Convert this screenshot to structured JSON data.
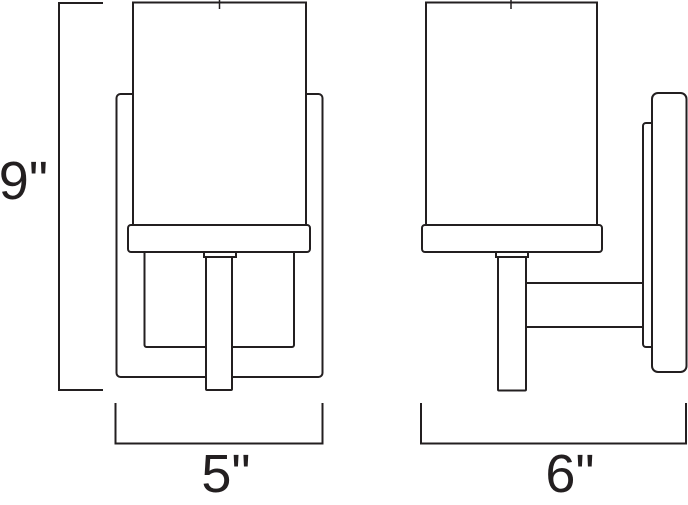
{
  "diagram": {
    "dimensions": {
      "height": {
        "label": "9\""
      },
      "width": {
        "label": "5\""
      },
      "depth": {
        "label": "6\""
      }
    },
    "colors": {
      "line": "#231f20",
      "background": "#ffffff",
      "fill": "#ffffff"
    }
  }
}
